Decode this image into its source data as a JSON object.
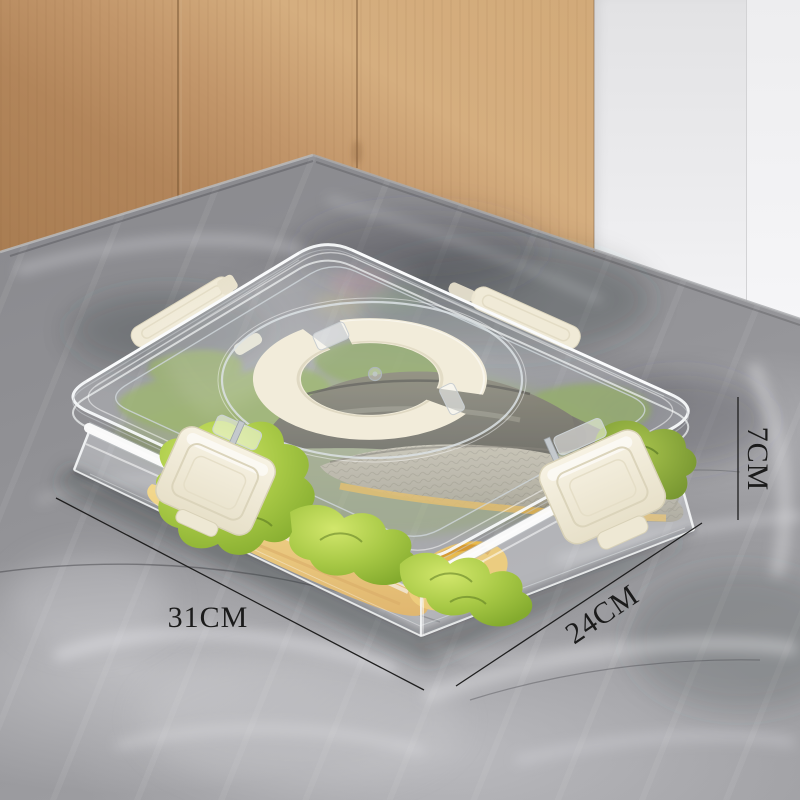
{
  "annotations": {
    "length_label": "31CM",
    "depth_label": "24CM",
    "height_label": "7CM"
  },
  "scene": {
    "colors": {
      "marble_base": "#929296",
      "wood_cabinet": "#c79a6b",
      "wall_white": "#ededef",
      "plastic_cream": "#f1ebd8",
      "lettuce_green": "#9cbe3d",
      "fish_belly_yellow": "#e9ba4d",
      "fish_body_silver": "#a39e8d",
      "annotation_line": "#1e1e1e"
    }
  }
}
